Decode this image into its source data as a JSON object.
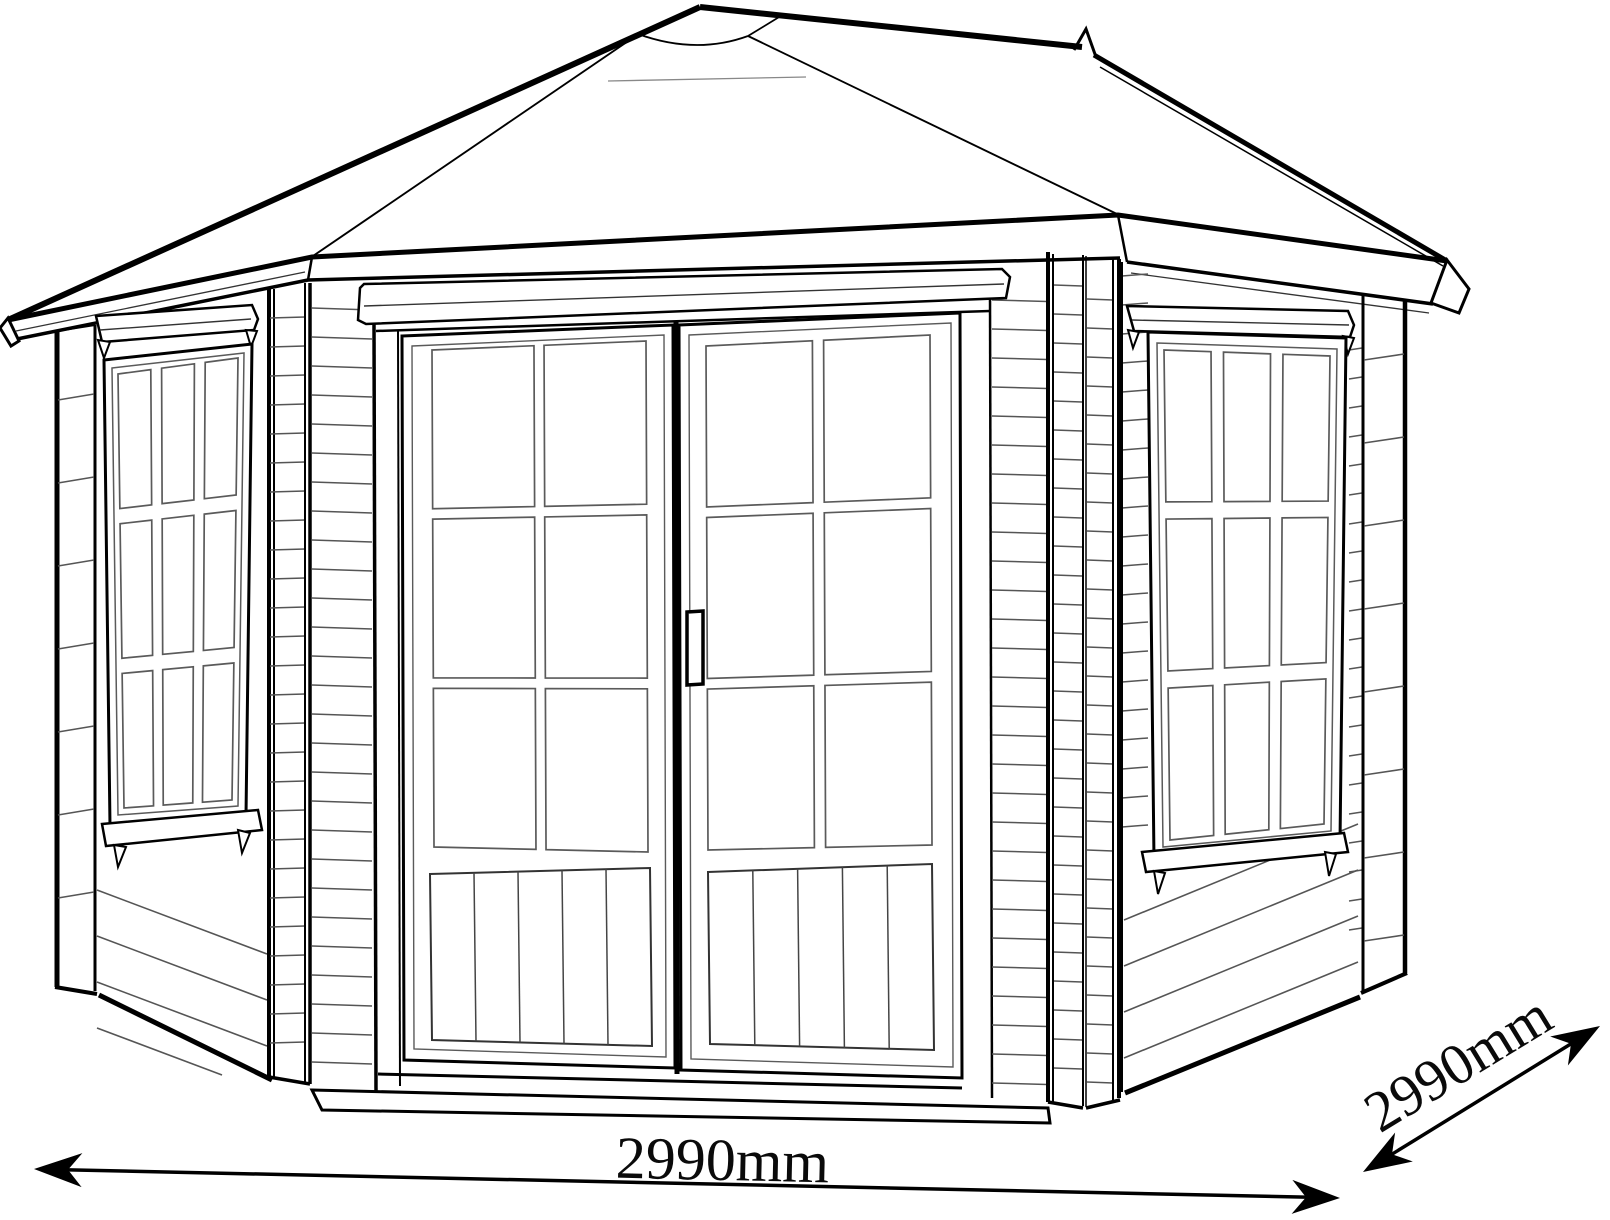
{
  "page": {
    "background": "#ffffff"
  },
  "drawing": {
    "subject": "Pentagonal corner summerhouse technical line drawing, front perspective view",
    "ink": "#000000",
    "detail_ink": "#555555"
  },
  "dimensions": {
    "front_width": "2990mm",
    "side_depth": "2990mm"
  }
}
